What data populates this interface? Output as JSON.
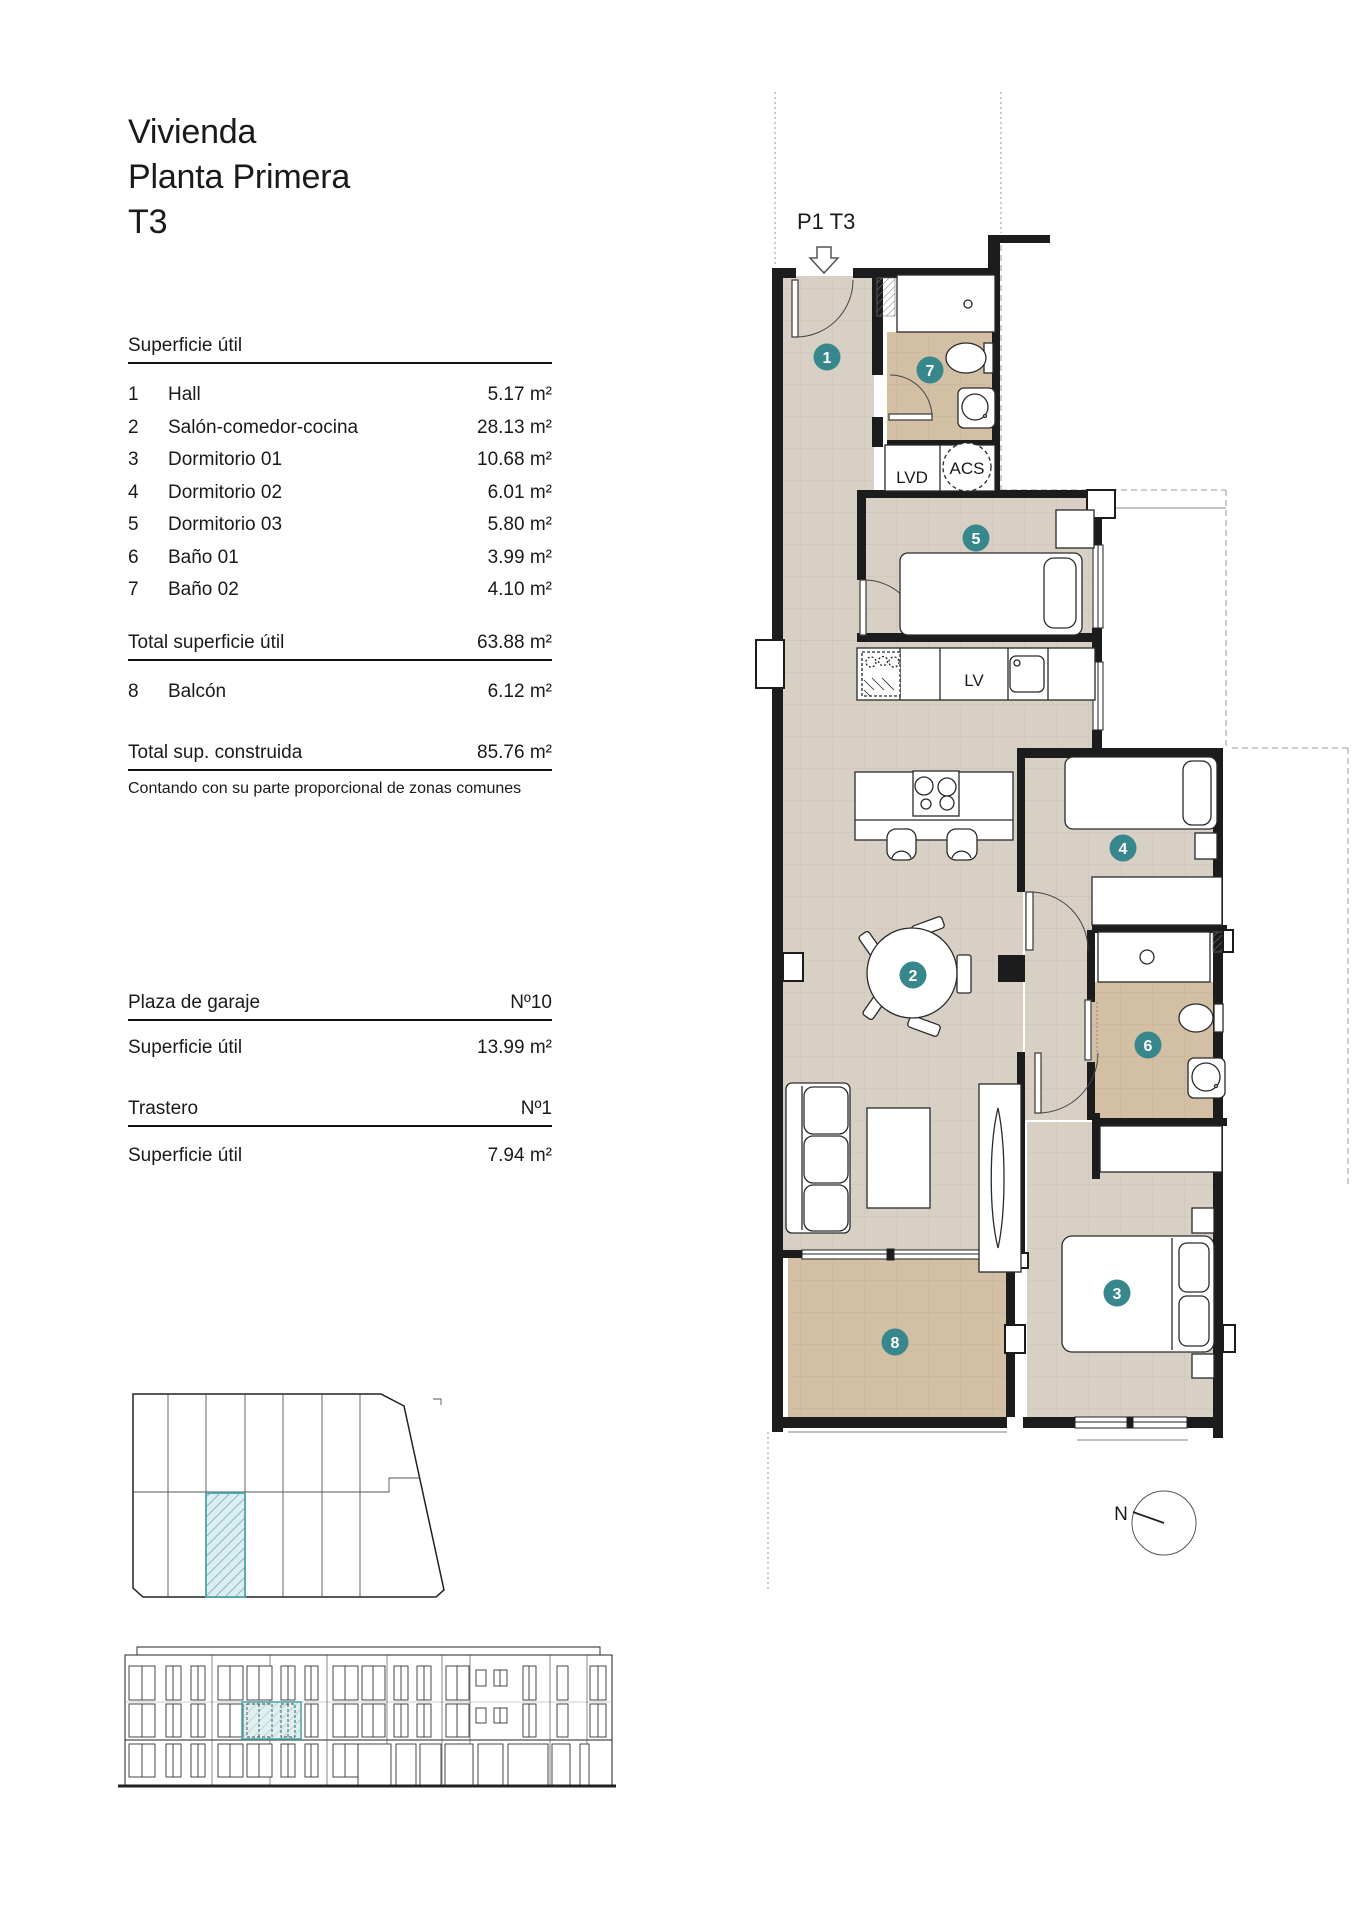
{
  "title": {
    "line1": "Vivienda",
    "line2": "Planta Primera",
    "line3": "T3"
  },
  "superficie": {
    "header": "Superficie útil",
    "rows": [
      {
        "num": "1",
        "name": "Hall",
        "area": "5.17 m²"
      },
      {
        "num": "2",
        "name": "Salón-comedor-cocina",
        "area": "28.13 m²"
      },
      {
        "num": "3",
        "name": "Dormitorio 01",
        "area": "10.68 m²"
      },
      {
        "num": "4",
        "name": "Dormitorio 02",
        "area": "6.01 m²"
      },
      {
        "num": "5",
        "name": "Dormitorio 03",
        "area": "5.80 m²"
      },
      {
        "num": "6",
        "name": "Baño 01",
        "area": "3.99 m²"
      },
      {
        "num": "7",
        "name": "Baño 02",
        "area": "4.10 m²"
      }
    ],
    "total_util": {
      "label": "Total superficie útil",
      "value": "63.88 m²"
    },
    "balcon": {
      "num": "8",
      "name": "Balcón",
      "area": "6.12 m²"
    },
    "total_construida": {
      "label": "Total sup. construida",
      "value": "85.76 m²"
    },
    "note": "Contando con su parte proporcional de zonas comunes"
  },
  "garaje": {
    "label": "Plaza de garaje",
    "number": "Nº10",
    "sup_label": "Superficie útil",
    "sup_value": "13.99 m²"
  },
  "trastero": {
    "label": "Trastero",
    "number": "Nº1",
    "sup_label": "Superficie útil",
    "sup_value": "7.94 m²"
  },
  "plan": {
    "unit_label": "P1 T3",
    "badges": {
      "b1": "1",
      "b2": "2",
      "b3": "3",
      "b4": "4",
      "b5": "5",
      "b6": "6",
      "b7": "7",
      "b8": "8"
    },
    "labels": {
      "lvd": "LVD",
      "acs": "ACS",
      "lv": "LV"
    },
    "north": "N"
  },
  "colors": {
    "floor": "#d8d0c5",
    "wet_floor": "#d2bfa4",
    "badge_teal": "#37878c",
    "highlight_teal": "#53a7ac",
    "wall": "#1c1c1c"
  }
}
